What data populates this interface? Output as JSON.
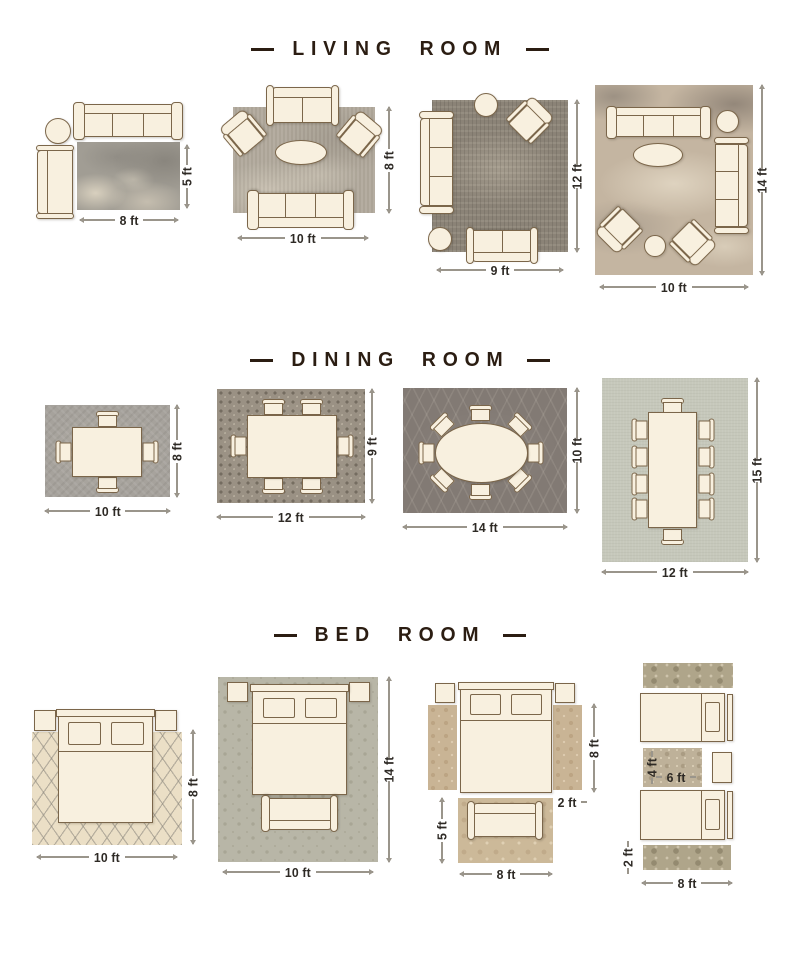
{
  "palette": {
    "background": "#ffffff",
    "furniture_fill": "#f8f0df",
    "furniture_outline": "#7b664a",
    "title_text": "#2b1d12",
    "dimension_text": "#2e2a25",
    "dimension_line": "#9a958b"
  },
  "sections": [
    {
      "title": "LIVING ROOM",
      "layouts": [
        {
          "width_label": "8 ft",
          "height_label": "5 ft"
        },
        {
          "width_label": "10 ft",
          "height_label": "8 ft"
        },
        {
          "width_label": "9 ft",
          "height_label": "12 ft"
        },
        {
          "width_label": "10 ft",
          "height_label": "14 ft"
        }
      ]
    },
    {
      "title": "DINING ROOM",
      "layouts": [
        {
          "width_label": "10 ft",
          "height_label": "8 ft"
        },
        {
          "width_label": "12 ft",
          "height_label": "9 ft"
        },
        {
          "width_label": "14 ft",
          "height_label": "10 ft"
        },
        {
          "width_label": "12 ft",
          "height_label": "15 ft"
        }
      ]
    },
    {
      "title": "BED ROOM",
      "layouts": [
        {
          "width_label": "10 ft",
          "height_label": "8 ft"
        },
        {
          "width_label": "10 ft",
          "height_label": "14 ft"
        },
        {
          "bed_height_label": "8 ft",
          "runner_width_label": "2 ft",
          "rug_height_label": "5 ft",
          "rug_width_label": "8 ft"
        },
        {
          "small_rug_height_label": "4 ft",
          "small_rug_width_label": "6 ft",
          "runner_height_label": "2 ft",
          "rug_width_label": "8 ft"
        }
      ]
    }
  ]
}
